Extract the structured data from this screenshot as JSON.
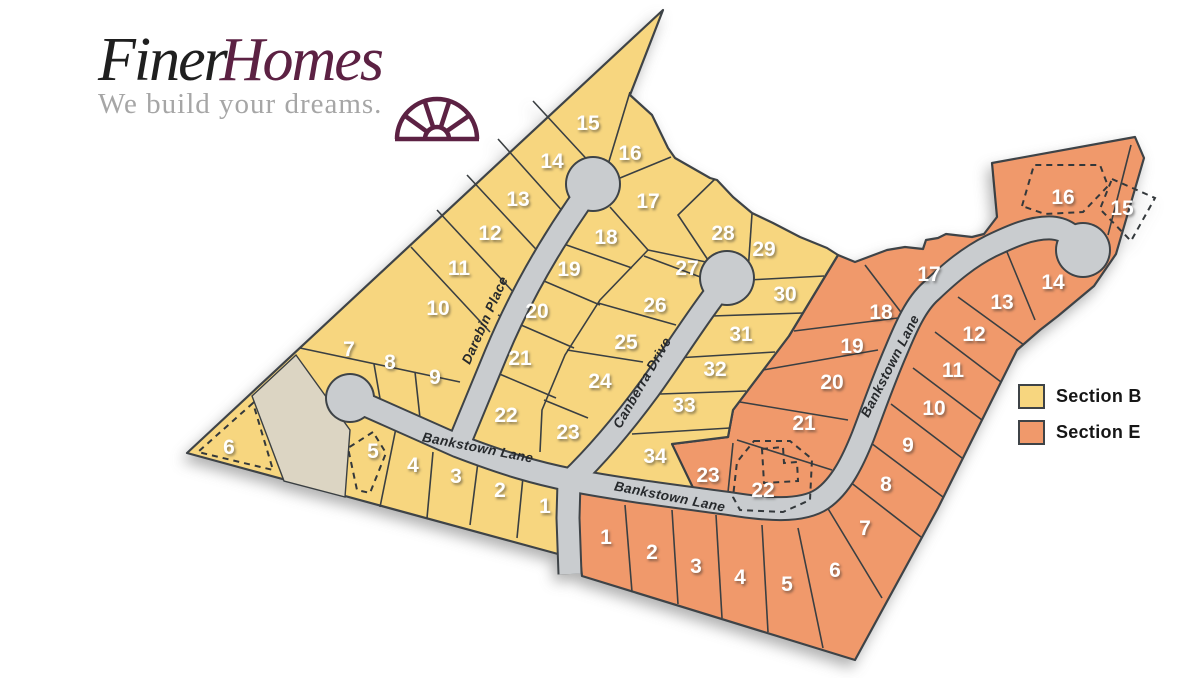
{
  "logo": {
    "title_part1": "Finer",
    "title_part2": "Homes",
    "tagline": "We build your dreams.",
    "colors": {
      "finer": "#1f1f1f",
      "homes": "#5c2143",
      "tagline": "#a6a6a6"
    }
  },
  "legend": {
    "items": [
      {
        "label": "Section B",
        "color": "#F7D67F"
      },
      {
        "label": "Section E",
        "color": "#F0996B"
      }
    ]
  },
  "map": {
    "colors": {
      "section_b": "#F7D67F",
      "section_e": "#F0996B",
      "tan": "#DCD5C3",
      "road_fill": "#C9CCCF",
      "road_casing": "#3E4347",
      "outline": "#3E4347",
      "lot_line": "#3A3F42",
      "lot_number": "#FFFFFF",
      "street_label": "#26292C"
    },
    "streets": [
      {
        "name": "Darebin Place",
        "x": 489,
        "y": 322,
        "rotation": -66
      },
      {
        "name": "Canberra Drive",
        "x": 646,
        "y": 385,
        "rotation": -60
      },
      {
        "name": "Bankstown Lane",
        "x": 477,
        "y": 452,
        "rotation": 11
      },
      {
        "name": "Bankstown Lane",
        "x": 669,
        "y": 501,
        "rotation": 11
      },
      {
        "name": "Bankstown Lane",
        "x": 894,
        "y": 368,
        "rotation": -63
      }
    ],
    "sections": [
      {
        "id": "B",
        "name": "Section B",
        "lots": [
          {
            "n": "1",
            "x": 545,
            "y": 505
          },
          {
            "n": "2",
            "x": 500,
            "y": 489
          },
          {
            "n": "3",
            "x": 456,
            "y": 475
          },
          {
            "n": "4",
            "x": 413,
            "y": 464
          },
          {
            "n": "5",
            "x": 373,
            "y": 450,
            "dashed": true
          },
          {
            "n": "6",
            "x": 229,
            "y": 446,
            "dashed": true
          },
          {
            "n": "7",
            "x": 349,
            "y": 348
          },
          {
            "n": "8",
            "x": 390,
            "y": 361
          },
          {
            "n": "9",
            "x": 435,
            "y": 376
          },
          {
            "n": "10",
            "x": 438,
            "y": 307
          },
          {
            "n": "11",
            "x": 459,
            "y": 267
          },
          {
            "n": "12",
            "x": 490,
            "y": 232
          },
          {
            "n": "13",
            "x": 518,
            "y": 198
          },
          {
            "n": "14",
            "x": 552,
            "y": 160
          },
          {
            "n": "15",
            "x": 588,
            "y": 122
          },
          {
            "n": "16",
            "x": 630,
            "y": 152
          },
          {
            "n": "17",
            "x": 648,
            "y": 200
          },
          {
            "n": "18",
            "x": 606,
            "y": 236
          },
          {
            "n": "19",
            "x": 569,
            "y": 268
          },
          {
            "n": "20",
            "x": 537,
            "y": 310
          },
          {
            "n": "21",
            "x": 520,
            "y": 357
          },
          {
            "n": "22",
            "x": 506,
            "y": 414
          },
          {
            "n": "23",
            "x": 568,
            "y": 431
          },
          {
            "n": "24",
            "x": 600,
            "y": 380
          },
          {
            "n": "25",
            "x": 626,
            "y": 341
          },
          {
            "n": "26",
            "x": 655,
            "y": 304
          },
          {
            "n": "27",
            "x": 687,
            "y": 267
          },
          {
            "n": "28",
            "x": 723,
            "y": 232
          },
          {
            "n": "29",
            "x": 764,
            "y": 248
          },
          {
            "n": "30",
            "x": 785,
            "y": 293
          },
          {
            "n": "31",
            "x": 741,
            "y": 333
          },
          {
            "n": "32",
            "x": 715,
            "y": 368
          },
          {
            "n": "33",
            "x": 684,
            "y": 404
          },
          {
            "n": "34",
            "x": 655,
            "y": 455
          }
        ]
      },
      {
        "id": "E",
        "name": "Section E",
        "lots": [
          {
            "n": "1",
            "x": 606,
            "y": 536
          },
          {
            "n": "2",
            "x": 652,
            "y": 551
          },
          {
            "n": "3",
            "x": 696,
            "y": 565
          },
          {
            "n": "4",
            "x": 740,
            "y": 576
          },
          {
            "n": "5",
            "x": 787,
            "y": 583
          },
          {
            "n": "6",
            "x": 835,
            "y": 569
          },
          {
            "n": "7",
            "x": 865,
            "y": 527
          },
          {
            "n": "8",
            "x": 886,
            "y": 483
          },
          {
            "n": "9",
            "x": 908,
            "y": 444
          },
          {
            "n": "10",
            "x": 934,
            "y": 407
          },
          {
            "n": "11",
            "x": 953,
            "y": 369
          },
          {
            "n": "12",
            "x": 974,
            "y": 333
          },
          {
            "n": "13",
            "x": 1002,
            "y": 301
          },
          {
            "n": "14",
            "x": 1053,
            "y": 281
          },
          {
            "n": "15",
            "x": 1122,
            "y": 207,
            "dashed": true
          },
          {
            "n": "16",
            "x": 1063,
            "y": 196,
            "dashed": true
          },
          {
            "n": "17",
            "x": 929,
            "y": 273
          },
          {
            "n": "18",
            "x": 881,
            "y": 311
          },
          {
            "n": "19",
            "x": 852,
            "y": 345
          },
          {
            "n": "20",
            "x": 832,
            "y": 381
          },
          {
            "n": "21",
            "x": 804,
            "y": 422
          },
          {
            "n": "22",
            "x": 763,
            "y": 489,
            "dashed": true
          },
          {
            "n": "23",
            "x": 708,
            "y": 474
          }
        ]
      }
    ],
    "geometry": {
      "section_e_outline": [
        [
          838,
          255
        ],
        [
          855,
          262
        ],
        [
          887,
          250
        ],
        [
          905,
          247
        ],
        [
          923,
          249
        ],
        [
          926,
          240
        ],
        [
          938,
          238
        ],
        [
          946,
          234
        ],
        [
          972,
          237
        ],
        [
          984,
          234
        ],
        [
          997,
          217
        ],
        [
          992,
          163
        ],
        [
          1135,
          137
        ],
        [
          1144,
          158
        ],
        [
          1116,
          254
        ],
        [
          1094,
          286
        ],
        [
          1058,
          316
        ],
        [
          1040,
          330
        ],
        [
          1017,
          350
        ],
        [
          938,
          508
        ],
        [
          855,
          660
        ],
        [
          582,
          576
        ],
        [
          570,
          470
        ],
        [
          660,
          448
        ],
        [
          672,
          444
        ],
        [
          728,
          437
        ],
        [
          733,
          410
        ],
        [
          789,
          336
        ]
      ],
      "section_b_outline": [
        [
          187,
          453
        ],
        [
          663,
          10
        ],
        [
          630,
          95
        ],
        [
          652,
          115
        ],
        [
          668,
          148
        ],
        [
          675,
          158
        ],
        [
          710,
          178
        ],
        [
          717,
          180
        ],
        [
          733,
          197
        ],
        [
          752,
          213
        ],
        [
          773,
          223
        ],
        [
          800,
          237
        ],
        [
          827,
          248
        ],
        [
          838,
          255
        ],
        [
          789,
          336
        ],
        [
          733,
          410
        ],
        [
          728,
          437
        ],
        [
          672,
          444
        ],
        [
          697,
          496
        ],
        [
          640,
          489
        ],
        [
          585,
          479
        ],
        [
          565,
          484
        ],
        [
          558,
          554
        ]
      ],
      "tan_strip": [
        [
          252,
          396
        ],
        [
          296,
          355
        ],
        [
          350,
          430
        ],
        [
          345,
          497
        ],
        [
          284,
          481
        ]
      ],
      "roads": [
        "M 350,398 L 458,446 C 505,464 536,473 571,480 C 622,490 682,497 732,504 C 764,509 801,513 822,499 C 841,486 853,461 863,436 C 873,410 883,381 896,351 C 906,327 916,304 931,291 C 951,272 969,257 991,246 C 1012,236 1032,227 1052,228 C 1067,229 1077,239 1083,250",
        "M 458,446 C 472,412 482,388 496,354 C 516,306 546,248 593,184",
        "M 570,574 L 568,518 L 569,482 C 592,460 621,427 649,389 C 673,356 701,311 727,279"
      ],
      "culdesacs": [
        {
          "cx": 350,
          "cy": 398,
          "r": 23
        },
        {
          "cx": 593,
          "cy": 184,
          "r": 26
        },
        {
          "cx": 727,
          "cy": 278,
          "r": 26
        },
        {
          "cx": 1083,
          "cy": 250,
          "r": 26
        }
      ],
      "lot_lines": [
        [
          [
            411,
            247
          ],
          [
            490,
            332
          ]
        ],
        [
          [
            437,
            210
          ],
          [
            516,
            295
          ]
        ],
        [
          [
            467,
            175
          ],
          [
            546,
            260
          ]
        ],
        [
          [
            498,
            139
          ],
          [
            574,
            224
          ]
        ],
        [
          [
            533,
            101
          ],
          [
            606,
            180
          ]
        ],
        [
          [
            630,
            92
          ],
          [
            607,
            168
          ]
        ],
        [
          [
            620,
            178
          ],
          [
            671,
            157
          ]
        ],
        [
          [
            610,
            207
          ],
          [
            648,
            250
          ]
        ],
        [
          [
            648,
            250
          ],
          [
            706,
            262
          ]
        ],
        [
          [
            715,
            179
          ],
          [
            678,
            215
          ],
          [
            710,
            263
          ]
        ],
        [
          [
            752,
            214
          ],
          [
            748,
            272
          ]
        ],
        [
          [
            748,
            280
          ],
          [
            824,
            276
          ]
        ],
        [
          [
            558,
            242
          ],
          [
            632,
            268
          ]
        ],
        [
          [
            523,
            272
          ],
          [
            600,
            305
          ]
        ],
        [
          [
            498,
            315
          ],
          [
            574,
            348
          ]
        ],
        [
          [
            483,
            367
          ],
          [
            556,
            398
          ]
        ],
        [
          [
            648,
            250
          ],
          [
            600,
            300
          ],
          [
            565,
            355
          ],
          [
            542,
            410
          ],
          [
            540,
            452
          ]
        ],
        [
          [
            588,
            418
          ],
          [
            544,
            400
          ]
        ],
        [
          [
            567,
            350
          ],
          [
            643,
            362
          ]
        ],
        [
          [
            598,
            303
          ],
          [
            676,
            325
          ]
        ],
        [
          [
            644,
            256
          ],
          [
            703,
            278
          ]
        ],
        [
          [
            712,
            316
          ],
          [
            803,
            313
          ]
        ],
        [
          [
            676,
            358
          ],
          [
            775,
            352
          ]
        ],
        [
          [
            660,
            394
          ],
          [
            746,
            391
          ]
        ],
        [
          [
            632,
            434
          ],
          [
            730,
            428
          ]
        ],
        [
          [
            300,
            348
          ],
          [
            460,
            382
          ]
        ],
        [
          [
            374,
            364
          ],
          [
            382,
            410
          ]
        ],
        [
          [
            415,
            372
          ],
          [
            420,
            418
          ]
        ],
        [
          [
            433,
            452
          ],
          [
            427,
            518
          ]
        ],
        [
          [
            478,
            462
          ],
          [
            470,
            525
          ]
        ],
        [
          [
            523,
            477
          ],
          [
            517,
            538
          ]
        ],
        [
          [
            396,
            428
          ],
          [
            380,
            507
          ]
        ],
        [
          [
            672,
            444
          ],
          [
            697,
            496
          ]
        ],
        [
          [
            625,
            505
          ],
          [
            632,
            592
          ]
        ],
        [
          [
            672,
            510
          ],
          [
            678,
            604
          ]
        ],
        [
          [
            716,
            515
          ],
          [
            722,
            618
          ]
        ],
        [
          [
            762,
            525
          ],
          [
            768,
            632
          ]
        ],
        [
          [
            798,
            528
          ],
          [
            823,
            648
          ]
        ],
        [
          [
            824,
            502
          ],
          [
            882,
            598
          ]
        ],
        [
          [
            845,
            478
          ],
          [
            921,
            537
          ]
        ],
        [
          [
            867,
            440
          ],
          [
            943,
            497
          ]
        ],
        [
          [
            891,
            404
          ],
          [
            962,
            458
          ]
        ],
        [
          [
            913,
            368
          ],
          [
            982,
            420
          ]
        ],
        [
          [
            935,
            332
          ],
          [
            1001,
            382
          ]
        ],
        [
          [
            958,
            297
          ],
          [
            1024,
            345
          ]
        ],
        [
          [
            1007,
            252
          ],
          [
            1035,
            320
          ]
        ],
        [
          [
            865,
            265
          ],
          [
            913,
            328
          ]
        ],
        [
          [
            794,
            331
          ],
          [
            898,
            318
          ]
        ],
        [
          [
            763,
            370
          ],
          [
            878,
            350
          ]
        ],
        [
          [
            740,
            402
          ],
          [
            848,
            420
          ]
        ],
        [
          [
            737,
            440
          ],
          [
            832,
            470
          ]
        ],
        [
          [
            733,
            443
          ],
          [
            727,
            502
          ]
        ],
        [
          [
            1131,
            145
          ],
          [
            1108,
            235
          ]
        ],
        [
          [
            997,
            217
          ],
          [
            992,
            163
          ]
        ]
      ],
      "dashed_shapes": [
        "M 253,403 L 198,452 L 273,470 Z",
        "M 373,432 L 348,448 L 357,490 L 370,493 L 386,453 Z",
        "M 1022,206 L 1034,165 L 1100,165 L 1108,186 L 1083,212 L 1045,214 Z",
        "M 1112,179 L 1155,198 L 1131,241 L 1100,209 Z",
        "M 754,441 L 790,441 L 812,459 L 810,500 L 783,512 L 740,510 L 733,497 L 737,462 Z",
        "M 762,449 L 783,447 L 784,463 L 797,462 L 798,481 L 764,483 Z"
      ]
    }
  }
}
